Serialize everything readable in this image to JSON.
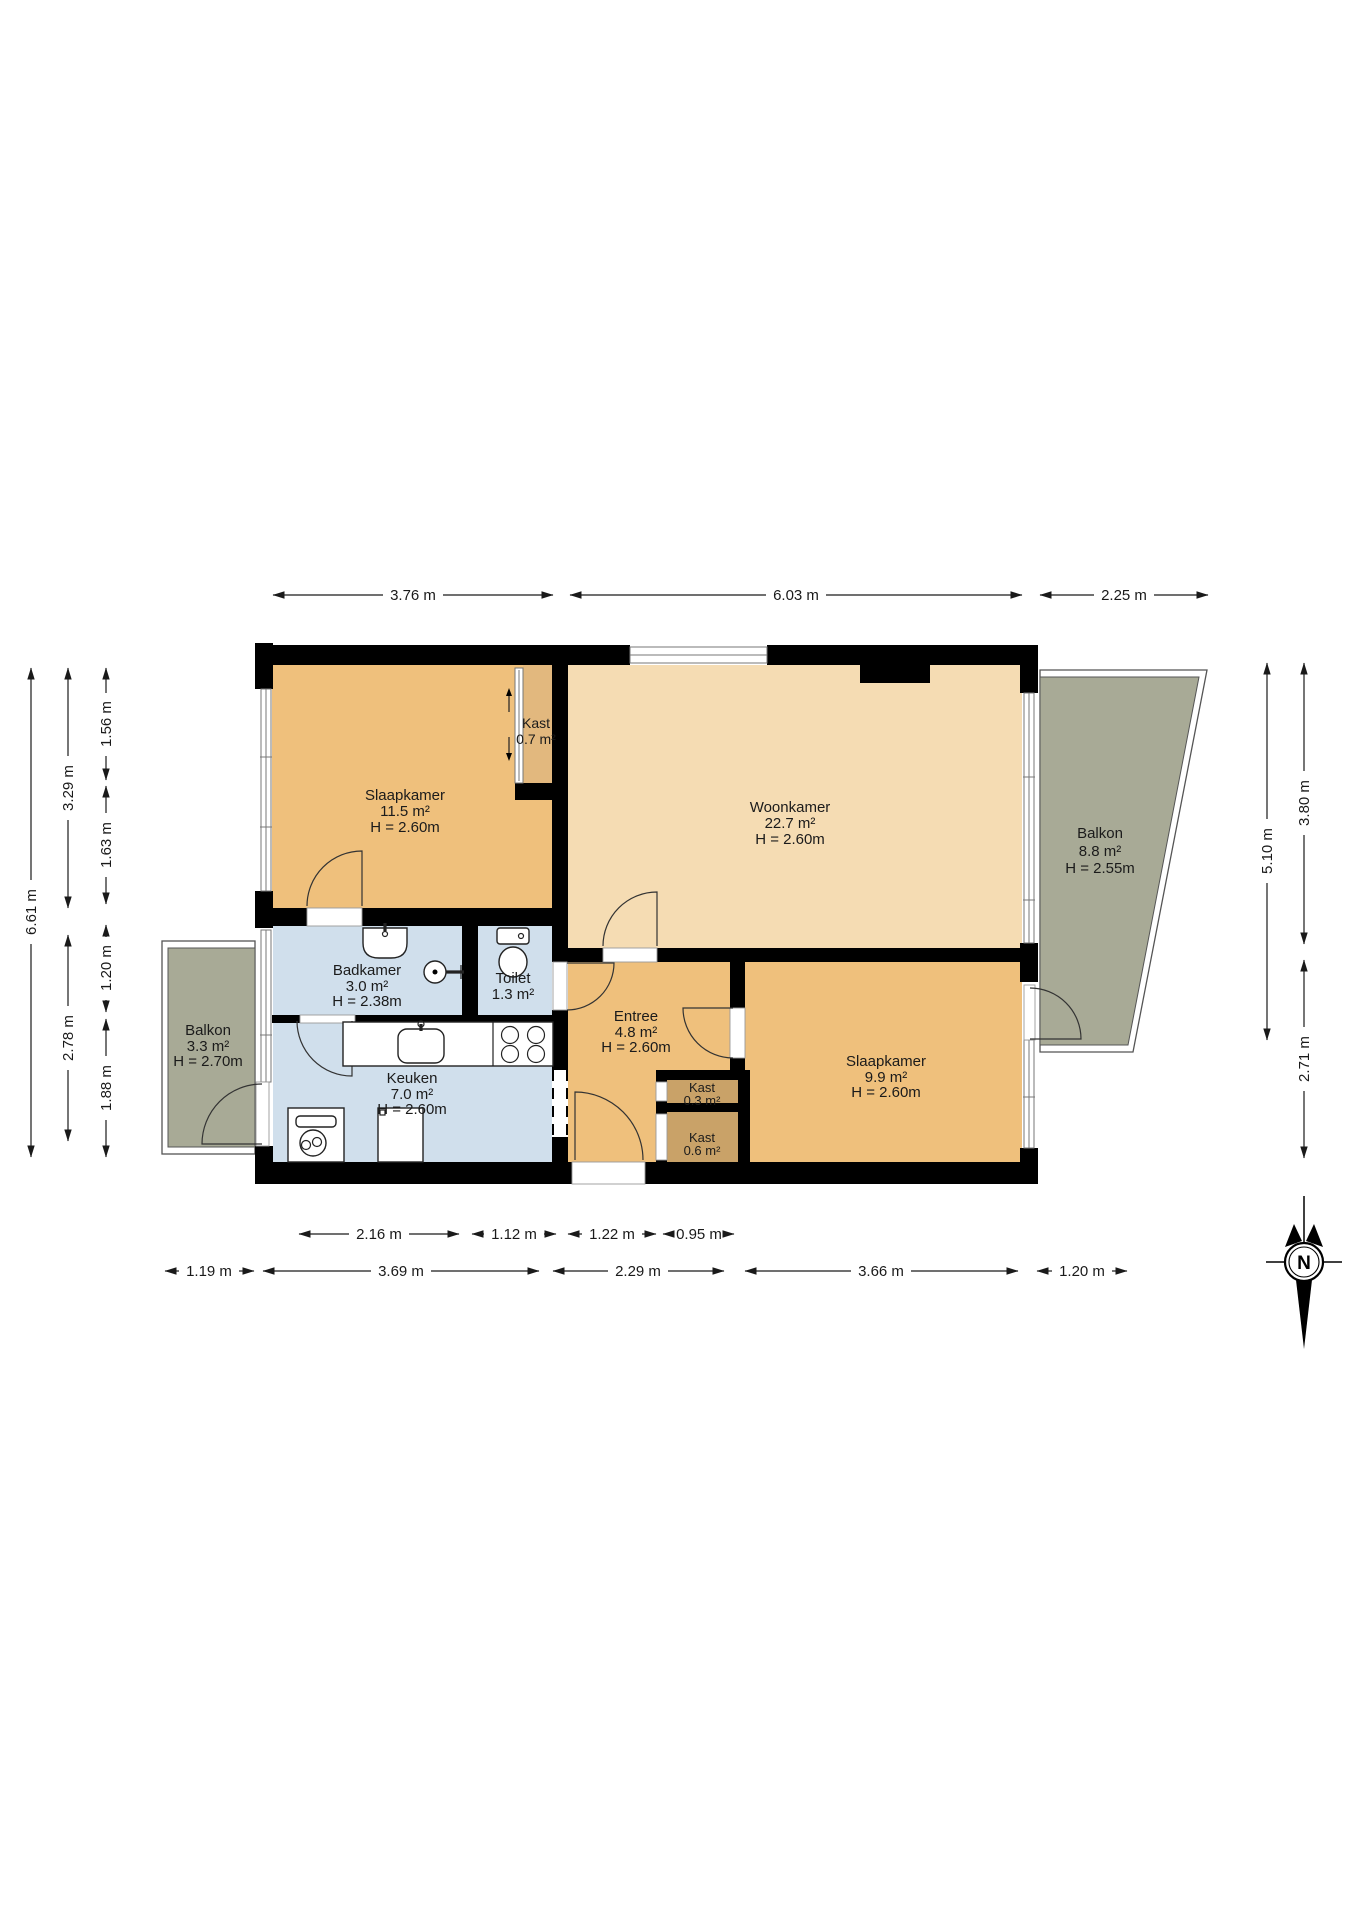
{
  "rooms": {
    "slaapkamer1": {
      "name": "Slaapkamer",
      "area": "11.5 m²",
      "height": "H = 2.60m"
    },
    "kast_07": {
      "name": "Kast",
      "area": "0.7 m²"
    },
    "woonkamer": {
      "name": "Woonkamer",
      "area": "22.7 m²",
      "height": "H = 2.60m"
    },
    "balkon_rechts": {
      "name": "Balkon",
      "area": "8.8 m²",
      "height": "H = 2.55m"
    },
    "badkamer": {
      "name": "Badkamer",
      "area": "3.0 m²",
      "height": "H = 2.38m"
    },
    "toilet": {
      "name": "Toilet",
      "area": "1.3 m²"
    },
    "entree": {
      "name": "Entree",
      "area": "4.8 m²",
      "height": "H = 2.60m"
    },
    "slaapkamer2": {
      "name": "Slaapkamer",
      "area": "9.9 m²",
      "height": "H = 2.60m"
    },
    "keuken": {
      "name": "Keuken",
      "area": "7.0 m²",
      "height": "H = 2.60m"
    },
    "balkon_links": {
      "name": "Balkon",
      "area": "3.3 m²",
      "height": "H = 2.70m"
    },
    "kast_03": {
      "name": "Kast",
      "area": "0.3 m²"
    },
    "kast_06": {
      "name": "Kast",
      "area": "0.6 m²"
    }
  },
  "dimensions": {
    "top": {
      "seg1": "3.76 m",
      "seg2": "6.03 m",
      "seg3": "2.25 m"
    },
    "left": {
      "total": "6.61 m",
      "upper": "3.29 m",
      "lower": "2.78 m",
      "sub1": "1.56 m",
      "sub2": "1.63 m",
      "sub3": "1.20 m",
      "sub4": "1.88 m"
    },
    "right": {
      "total": "5.10 m",
      "upper": "3.80 m",
      "lower": "2.71 m"
    },
    "bottom_inner": {
      "seg1": "2.16 m",
      "seg2": "1.12 m",
      "seg3": "1.22 m",
      "seg4": "0.95 m"
    },
    "bottom_outer": {
      "seg1": "1.19 m",
      "seg2": "3.69 m",
      "seg3": "2.29 m",
      "seg4": "3.66 m",
      "seg5": "1.20 m"
    }
  },
  "compass": {
    "north_label": "N"
  },
  "colors": {
    "wall": "#000000",
    "bedroom_orange": "#efc07c",
    "living_tan": "#f5dcb3",
    "wet_room_blue": "#d0dfec",
    "balcony_green": "#a8aa96",
    "closet_light": "#e2b87e",
    "closet_dark": "#c9a268"
  }
}
